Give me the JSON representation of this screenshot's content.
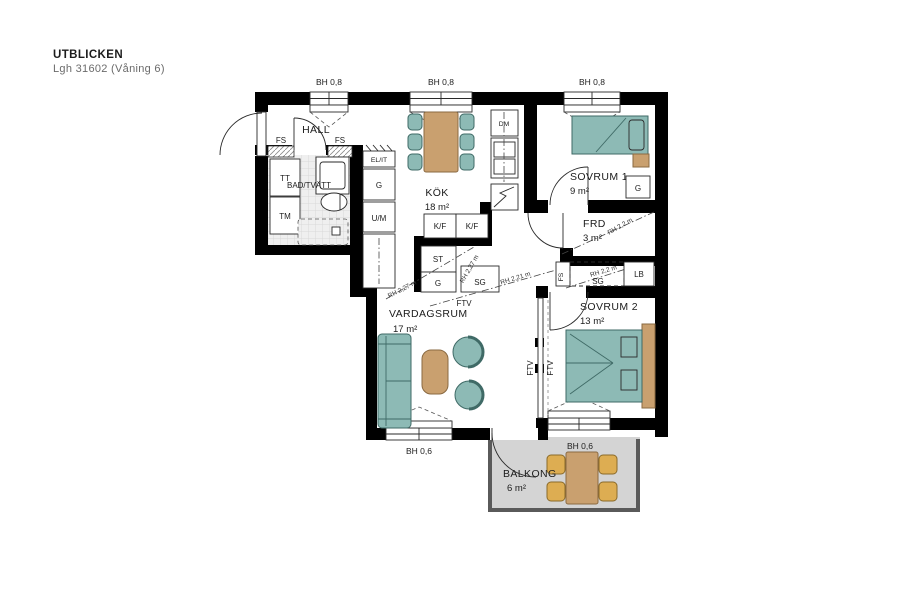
{
  "title": {
    "project": "UTBLICKEN",
    "apartment": "Lgh 31602 (Våning 6)"
  },
  "rooms": {
    "hall": {
      "name": "HALL"
    },
    "bathroom": {
      "name": "BAD/TVÄTT"
    },
    "kitchen": {
      "name": "KÖK",
      "area": "18 m²"
    },
    "bedroom1": {
      "name": "SOVRUM 1",
      "area": "9 m²"
    },
    "storage": {
      "name": "FRD",
      "area": "3 m²"
    },
    "bedroom2": {
      "name": "SOVRUM 2",
      "area": "13 m²"
    },
    "living": {
      "name": "VARDAGSRUM",
      "area": "17 m²"
    },
    "balcony": {
      "name": "BALKONG",
      "area": "6 m²"
    }
  },
  "closets": {
    "fs_left": "FS",
    "fs_right": "FS",
    "el_it": "EL/IT",
    "g_hall": "G",
    "um": "U/M",
    "tt": "TT",
    "tm": "TM",
    "dm": "DM",
    "kf_left": "K/F",
    "kf_right": "K/F",
    "st": "ST",
    "g_kitchen": "G",
    "sg_kitchen": "SG",
    "g_bedroom1": "G",
    "fs_corridor": "FS",
    "sg_corridor": "SG",
    "lb": "LB"
  },
  "window_labels": {
    "top1": "BH 0,8",
    "top2": "BH 0,8",
    "top3": "BH 0,8",
    "bottom_left": "BH 0,6",
    "balcony": "BH 0,6"
  },
  "annotations": {
    "ftv_corridor": "FTV",
    "ftv_left": "FTV",
    "ftv_right": "FTV",
    "rh_a": "RH 2,27 m",
    "rh_b": "RH 2,27 m",
    "rh_c": "RH 2,21 m",
    "rh_frd": "RH 2,2 m",
    "rh_sg": "RH 2,2 m"
  },
  "colors": {
    "wall": "#000000",
    "furniture_teal": "#8dbab5",
    "furniture_tan": "#c9a06f",
    "chair_yellow": "#ddad52",
    "balcony_floor": "#d4d4d4",
    "bathroom_floor": "#efefef"
  }
}
